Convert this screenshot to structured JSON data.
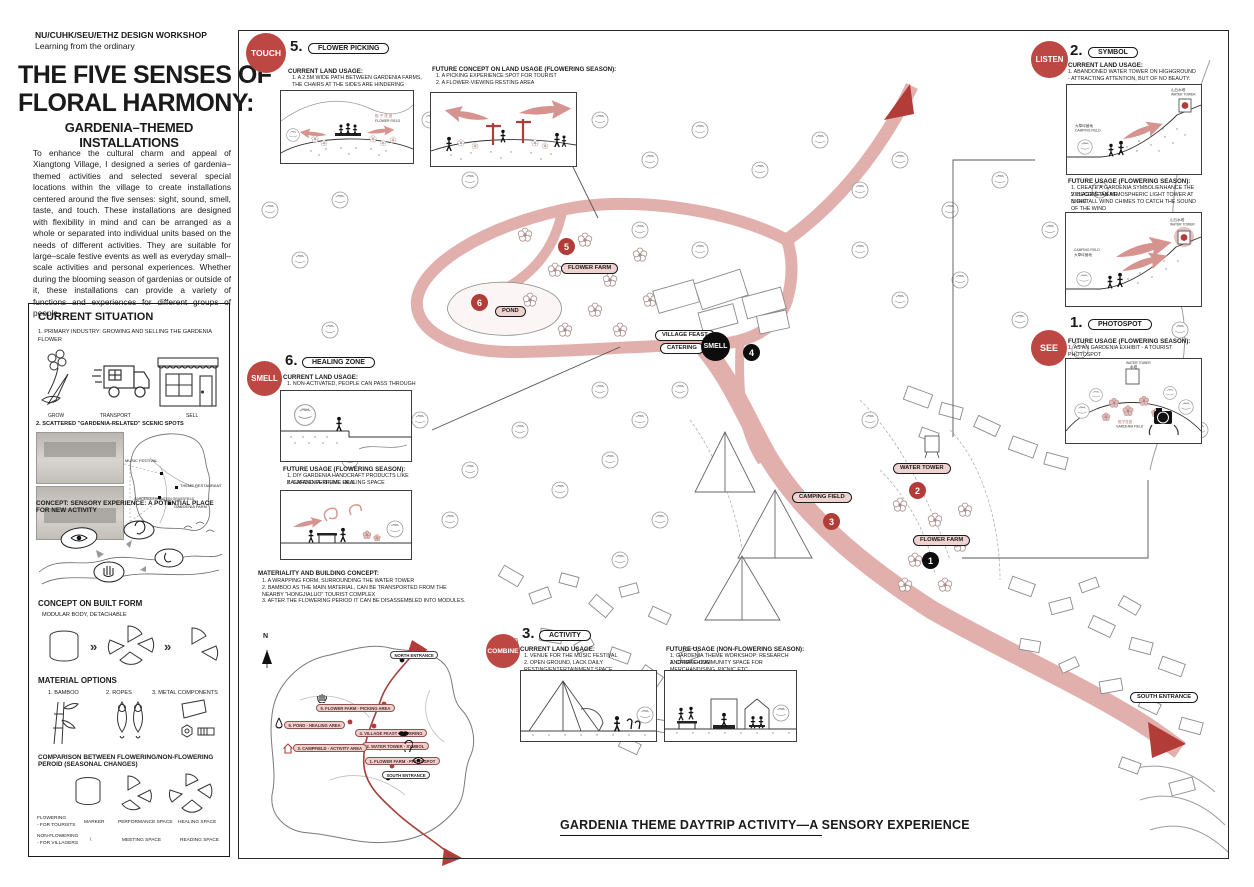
{
  "header": {
    "workshop": "NU/CUHK/SEU/ETHZ DESIGN WORKSHOP",
    "tagline": "Learning from the ordinary",
    "title_line1": "THE FIVE SENSES OF",
    "title_line2": "FLORAL HARMONY:",
    "subtitle": "GARDENIA–THEMED INSTALLATIONS",
    "intro": "To enhance the cultural charm and appeal of Xiangtong Village, I designed a series of gardenia–themed activities and selected several special locations within the village to create installations centered around the five senses: sight, sound, smell, taste, and touch. These installations are designed with flexibility in mind and can be arranged as a whole or separated into individual units based on the needs of different activities. They are suitable for large–scale festive events as well as everyday small–scale activities and personal experiences. Whether during the blooming season of gardenias or outside of it, these installations can provide a variety of functions and experiences for different groups of people."
  },
  "situation": {
    "heading": "CURRENT SITUATION",
    "item1": "1.   PRIMARY INDUSTRY: GROWING AND SELLING THE GARDENIA FLOWER",
    "icon_labels": [
      "GROW",
      "TRANSPORT",
      "SELL"
    ],
    "item2": "2. SCATTERED \"GARDENIA-RELATED\" SCENIC SPOTS",
    "minimap_labels": [
      "MUSIC FESTIVAL",
      "THEME RESTAURANT",
      "GARDENIA EXHIBITION GRASSFIELD",
      "GARDENIA FARM",
      "MARKET"
    ],
    "concept": "CONCEPT: SENSORY EXPERIENCE: A POTENTIAL PLACE FOR NEW ACTIVITY",
    "built_form_heading": "CONCEPT ON BUILT FORM",
    "built_form_sub": "MODULAR BODY, DETACHABLE",
    "material_heading": "MATERIAL OPTIONS",
    "materials": [
      "1.  BAMBOO",
      "2. ROPES",
      "3. METAL COMPONENTS"
    ],
    "comparison_heading": "COMPARISON BETWEEN FLOWERING/NON-FLOWERING PEROID (SEASONAL CHANGES)",
    "comparison": {
      "row1_label_1": "FLOWERING",
      "row1_label_2": "- FOR TOURISTS",
      "row1_cells": [
        "MARKER",
        "PERFORMANCE SPACE",
        "HEALING SPACE"
      ],
      "row2_label_1": "NON-FLOWERING",
      "row2_label_2": "- FOR VILLAGERS",
      "row2_cells": [
        "\\",
        "MEETING SPACE",
        "READING SPACE"
      ]
    }
  },
  "sections": {
    "touch": {
      "sense": "TOUCH",
      "num": "5.",
      "tag": "FLOWER PICKING",
      "current_heading": "CURRENT LAND USAGE:",
      "current_1": "1.  A 2.5M WIDE PATH BETWEEN GARDENIA FARMS, THE CHAIRS AT THE SIDES ARE HINDERING INTERACTION BETWEEN THE PEOPLE AND FLOWERS",
      "future_heading": "FUTURE CONCEPT ON LAND USAGE (FLOWERING SEASON):",
      "future_1": "1.  A PICKING EXPERIENCE SPOT FOR TOURIST",
      "future_2": "2.  A FLOWER-VIEWING RESTING AREA",
      "label_cn": "栀 子 花 田",
      "label_en": "FLOWER FIELD"
    },
    "listen": {
      "sense": "LISTEN",
      "num": "2.",
      "tag": "SYMBOL",
      "current_heading": "CURRENT LAND USAGE:",
      "current_1": "1. ABANDONED WATER TOWER ON HIGHGROUND - ATTRACTING ATTENTION, BUT OF NO BEAUTY.",
      "tower_cn": "山丘水塔",
      "tower_en": "WATER TOWER",
      "camp_cn": "大草坪营地",
      "camp_en": "CAMPING FIELD",
      "future_heading": "FUTURE USAGE (FLOWERING SEASON):",
      "future_1": "1.  CREATE A GARDENIA SYMBOL/ENHANCE THE VILLAGE'S THEME",
      "future_2": "2.  BECOME AN ATMOSPHERIC LIGHT TOWER AT NIGHT",
      "future_3": "3.  INSTALL WIND CHIMES TO CATCH THE SOUND OF THE WIND"
    },
    "see": {
      "sense": "SEE",
      "num": "1.",
      "tag": "PHOTOSPOT",
      "future_heading": "FUTURE USAGE (FLOWERING SEASON):",
      "future_1": "1. AS AN GARDENIA EXHIBIT - A TOURIST PHOTOSPOT",
      "tower_en": "WATER TOWER",
      "tower_cn": "水塔",
      "field_cn": "栀子花田",
      "field_en": "GARDENIA FIELD"
    },
    "smell": {
      "sense": "SMELL",
      "num": "6.",
      "tag": "HEALING ZONE",
      "current_heading": "CURRENT LAND USAGE:",
      "current_1": "1.  NON-ACTIVATED, PEOPLE CAN PASS THROUGH",
      "future_heading": "FUTURE USAGE (FLOWERING SEASON):",
      "future_1": "1.  DIY GARDENIA HANDCRAFT PRODUCTS LIKE BALM AND PERFUME OILS",
      "future_2": "2.  GARDENIA-THEME HEALING SPACE"
    },
    "combine": {
      "sense": "COMBINE",
      "num": "3.",
      "tag": "ACTIVITY",
      "current_heading": "CURRENT LAND USAGE:",
      "current_1": "1.  VENUE FOR THE MUSIC FESTIVAL",
      "current_2": "2.  OPEN GROUND, LACK DAILY RESTING/ENTERTAINMENT SPACE",
      "future_heading": "FUTURE USAGE (NON-FLOWERING SEASON):",
      "future_1": "1.  GARDENIA THEME WORKSHOP: RESEARCH AND TEACHING",
      "future_2": "2.  CREATE COMMUNITY SPACE FOR MERCHANDISING, PICNIC ETC."
    }
  },
  "materiality": {
    "heading": "MATERIALITY AND BUILDING CONCEPT:",
    "item1": "1.  A WRAPPING FORM, SURROUNDING THE WATER TOWER",
    "item2": "2.  BAMBOO AS THE MAIN MATERIAL, CAN BE TRANSPORTED FROM THE NEARBY \"HONGJIALUO\" TOURIST COMPLEX",
    "item3": "3.  AFTER THE FLOWERING PERIOD IT CAN BE DISASSEMBLED INTO MODULES."
  },
  "map": {
    "pills": {
      "flower_farm_top": "FLOWER FARM",
      "pond": "POND",
      "village_feast": "VILLAGE FEAST",
      "catering": "CATERING",
      "water_tower": "WATER TOWER",
      "camping_field": "CAMPING FIELD",
      "flower_farm_bottom": "FLOWER FARM",
      "south_entrance": "SOUTH ENTRANCE"
    },
    "circles": {
      "n1": "1",
      "n2": "2",
      "n3": "3",
      "n4": "4",
      "n5": "5",
      "n6": "6",
      "smell": "SMELL"
    }
  },
  "keymap": {
    "north": "N",
    "items": [
      "NORTH ENTRANCE",
      "5. FLOWER FARM - PICKING AREA",
      "6. POND - HEALING AREA",
      "4. VILLAGE FEAST - CATERING",
      "2. WATER TOWER - SYMBOL",
      "3. CAMPFIELD - ACTIVITY AREA",
      "1. FLOWER FARM - PHOTOSPOT",
      "SOUTH ENTRANCE"
    ]
  },
  "footer": {
    "title": "GARDENIA THEME DAYTRIP ACTIVITY—A SENSORY EXPERIENCE"
  },
  "colors": {
    "accent": "#bd4742",
    "road": "#e2b0ac",
    "pill_pink": "#eed3d0"
  }
}
